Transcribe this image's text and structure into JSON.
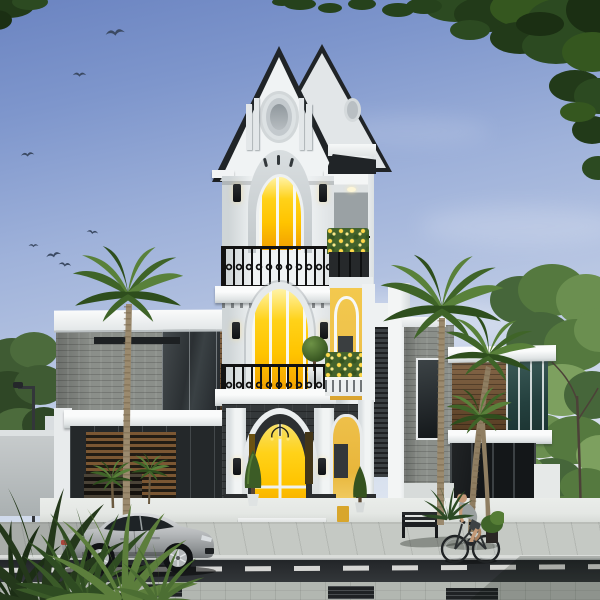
{
  "scene": {
    "type": "architectural-rendering",
    "description": "3D exterior render of a narrow four-storey neoclassical tower house with twin black-edged gables, an oval gable medallion, glowing amber arched windows and doors, two ornate black iron balconies and yellow-walled arched niches, flanked by flat-roofed modern wings of grey stone, dark glass and timber; palm trees, flower boxes, a street lamp, a parked silver coupe, a park bench and a passing cyclist on the paved street; birds fly in a blue sky with overhanging tree foliage in the corners.",
    "time_of_day": "day",
    "counts": {
      "birds": 7,
      "palm_trees": 4,
      "balconies": 2,
      "gables": 2
    },
    "objects": [
      "sky",
      "clouds",
      "birds",
      "overhanging-foliage",
      "background-trees",
      "distant-building",
      "street-lamp",
      "boundary-wall",
      "left-wing",
      "tower-house",
      "right-wing",
      "palm-trees",
      "flower-boxes",
      "sidewalk",
      "road",
      "pavement",
      "silver-coupe",
      "bench",
      "cyclist",
      "foreground-plants"
    ]
  },
  "palette": {
    "sky_top": "#6b84c1",
    "sky_mid": "#9fb2da",
    "sky_low": "#d7e0ee",
    "sky_horizon": "#ecf0f6",
    "white": "#f0f3f4",
    "white_hi": "#fafbfb",
    "wshadow": "#cfd5d7",
    "wshade": "#dfe3e5",
    "roof": "#202427",
    "glow_hi": "#fff3a6",
    "glow": "#ffd219",
    "glow_deep": "#f29f00",
    "ywall": "#eec04a",
    "charcoal": "#34383a",
    "stone": "#8b8f8a",
    "wood": "#75522f",
    "rail": "#121212",
    "palm1": "#59813a",
    "palm2": "#3f6428",
    "palm3": "#2e4e1d",
    "trunk": "#9b8a6e",
    "trunk_dk": "#77664c",
    "fol_dk": "#22371a",
    "fol_md": "#2f4c22",
    "tree_sun": "#6f9350",
    "sidewalk": "#c5c9c4",
    "road": "#2a2d30",
    "pave": "#b2b7b1",
    "terrace": "#e4e7e4",
    "car": "#b7babc",
    "bird": "#3b4a63",
    "skin": "#c49a78",
    "shirt": "#9aa0a0",
    "distant": "#dfe3e4"
  }
}
